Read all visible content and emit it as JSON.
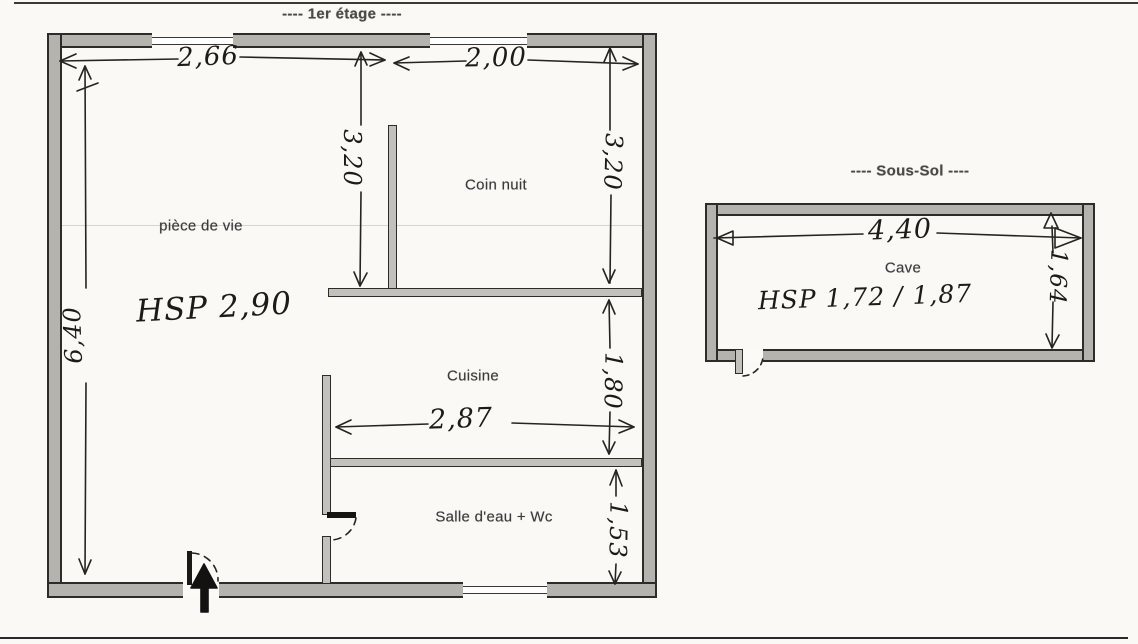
{
  "first_floor": {
    "title": "----  1er étage  ----",
    "rooms": {
      "living": "pièce de vie",
      "night": "Coin nuit",
      "kitchen": "Cuisine",
      "bath": "Salle d'eau + Wc"
    },
    "hsp": "HSP 2,90",
    "dims": {
      "top_left": "2,66",
      "top_right": "2,00",
      "left": "6,40",
      "middle_vertical": "3,20",
      "right_vertical": "3,20",
      "kitchen_depth": "1,80",
      "kitchen_width": "2,87",
      "bath_depth": "1,53"
    }
  },
  "basement": {
    "title": "----  Sous-Sol  ----",
    "rooms": {
      "cave": "Cave"
    },
    "hsp": "HSP 1,72 / 1,87",
    "dims": {
      "width": "4,40",
      "depth": "1,64"
    }
  }
}
